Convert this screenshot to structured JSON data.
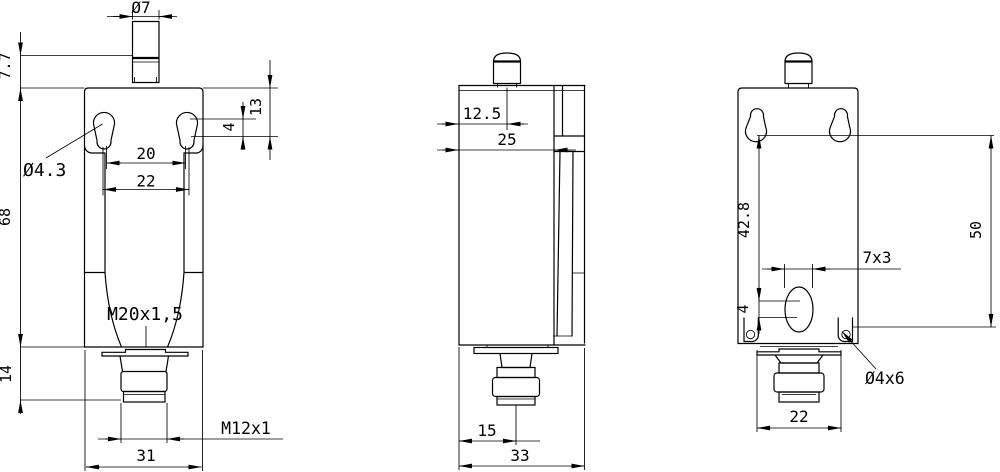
{
  "drawing": {
    "colors": {
      "background": "#ffffff",
      "line": "#000000"
    },
    "front_view": {
      "dims": {
        "plunger_diameter": "Ø7",
        "pretravel": "7.7",
        "slot_height": "13",
        "slot_center_offset": "4",
        "hole_span_inner": "20",
        "hole_span": "22",
        "mount_hole_diameter": "Ø4.3",
        "body_height": "68",
        "head_thread": "M20x1,5",
        "connector_height": "14",
        "connector_thread": "M12x1",
        "body_width": "31"
      }
    },
    "side_view": {
      "dims": {
        "plunger_center": "12.5",
        "body_depth": "25",
        "connector_center": "15",
        "overall_depth": "33"
      }
    },
    "rear_view": {
      "dims": {
        "slot_center_drop": "42.8",
        "mount_span": "50",
        "slot_size": "7x3",
        "hole_offset": "4",
        "corner_hole": "Ø4x6",
        "connector_flange_width": "22"
      }
    }
  }
}
